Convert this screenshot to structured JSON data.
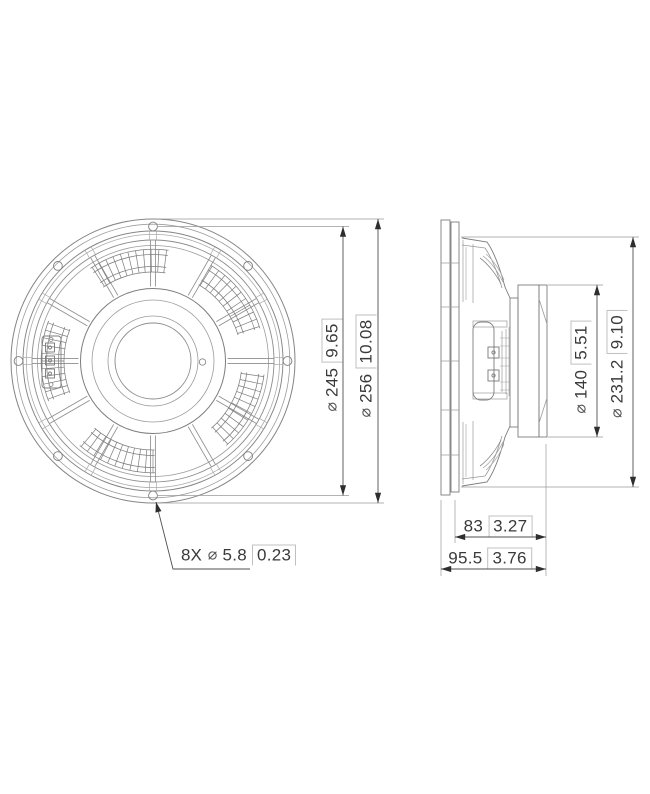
{
  "front_view": {
    "description": "loudspeaker rear view",
    "dim_bolt_circle": {
      "diameter_symbol": "⌀",
      "metric": "245",
      "imperial": "9.65"
    },
    "dim_outer_diameter": {
      "diameter_symbol": "⌀",
      "metric": "256",
      "imperial": "10.08"
    },
    "dim_mounting_holes": {
      "count": "8X",
      "diameter_symbol": "⌀",
      "metric": "5.8",
      "imperial": "0.23"
    }
  },
  "side_view": {
    "description": "loudspeaker side profile view",
    "dim_magnet_diameter": {
      "diameter_symbol": "⌀",
      "metric": "140",
      "imperial": "5.51"
    },
    "dim_basket_diameter": {
      "diameter_symbol": "⌀",
      "metric": "231.2",
      "imperial": "9.10"
    },
    "dim_depth_to_flange": {
      "metric": "83",
      "imperial": "3.27"
    },
    "dim_total_depth": {
      "metric": "95.5",
      "imperial": "3.76"
    }
  },
  "style": {
    "line_color": "#808080",
    "dimension_color": "#4a4a4a",
    "text_color": "#3a3a3a"
  }
}
